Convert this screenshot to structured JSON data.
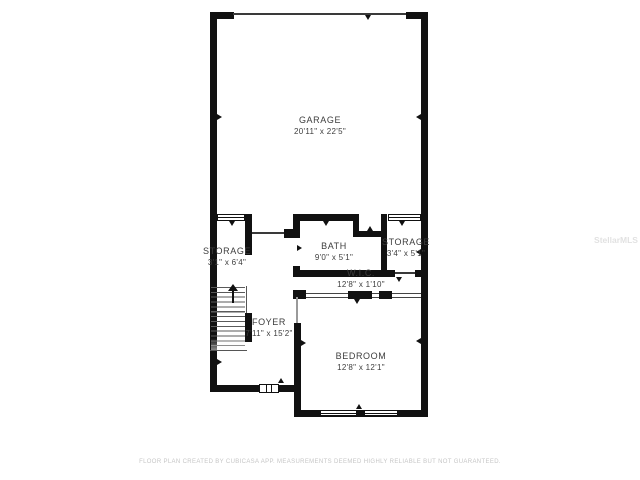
{
  "plan": {
    "type": "floor-plan",
    "rooms": [
      {
        "id": "garage",
        "name": "GARAGE",
        "dims": "20'11\" x 22'5\""
      },
      {
        "id": "bath",
        "name": "BATH",
        "dims": "9'0\" x 5'1\""
      },
      {
        "id": "storage_right",
        "name": "STORAGE",
        "dims": "3'4\" x 5'1\""
      },
      {
        "id": "storage_left",
        "name": "STORAGE",
        "dims": "3'1\" x 6'4\""
      },
      {
        "id": "wic",
        "name": "W.I.C.",
        "dims": "12'8\" x 1'10\""
      },
      {
        "id": "foyer",
        "name": "FOYER",
        "dims": "7'11\" x 15'2\""
      },
      {
        "id": "bedroom",
        "name": "BEDROOM",
        "dims": "12'8\" x 12'1\""
      }
    ]
  },
  "footer": {
    "disclaimer": "FLOOR PLAN CREATED BY CUBICASA APP. MEASUREMENTS DEEMED HIGHLY RELIABLE BUT NOT GUARANTEED."
  },
  "watermark": {
    "text": "StellarMLS"
  },
  "colors": {
    "wall": "#111111",
    "label": "#3d3d3d",
    "disclaimer_text": "#c6c6c6",
    "background": "#ffffff"
  }
}
